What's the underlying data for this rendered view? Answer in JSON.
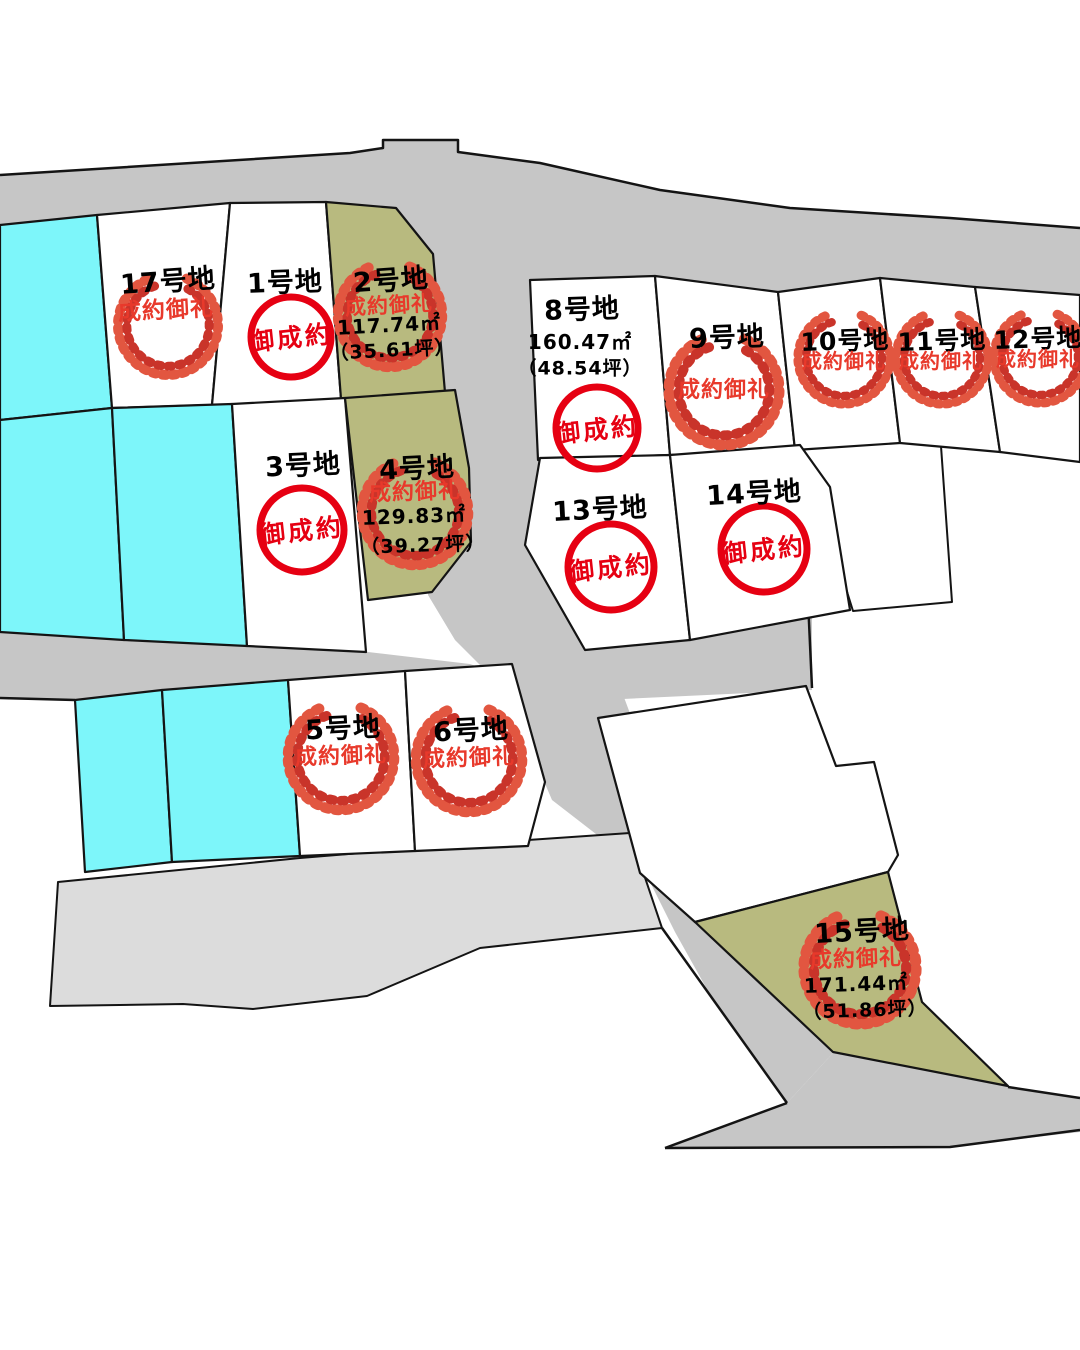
{
  "map": {
    "colors": {
      "road": "#C6C6C6",
      "road_light": "#DCDCDC",
      "parcel_white": "#FFFFFF",
      "parcel_cyan": "#7DF6FA",
      "parcel_olive": "#B8BA7F",
      "outline": "#141414",
      "stamp_circle_red": "#E60012",
      "wreath_outer": "#E25640",
      "wreath_inner": "#C9342A",
      "status_text_red": "#E8392B"
    }
  },
  "lots": {
    "lot1": {
      "name": "1号地",
      "stamp": "circle",
      "stamp_text": "御成約"
    },
    "lot2": {
      "name": "2号地",
      "stamp": "wreath",
      "stamp_text": "成約御礼",
      "area_m2": "117.74㎡",
      "area_tsubo": "（35.61坪）"
    },
    "lot3": {
      "name": "3号地",
      "stamp": "circle",
      "stamp_text": "御成約"
    },
    "lot4": {
      "name": "4号地",
      "stamp": "wreath",
      "stamp_text": "成約御礼",
      "area_m2": "129.83㎡",
      "area_tsubo": "（39.27坪）"
    },
    "lot5": {
      "name": "5号地",
      "stamp": "wreath",
      "stamp_text": "成約御礼"
    },
    "lot6": {
      "name": "6号地",
      "stamp": "wreath",
      "stamp_text": "成約御礼"
    },
    "lot8": {
      "name": "8号地",
      "stamp": "circle",
      "stamp_text": "御成約",
      "area_m2": "160.47㎡",
      "area_tsubo": "（48.54坪）"
    },
    "lot9": {
      "name": "9号地",
      "stamp": "wreath",
      "stamp_text": "成約御礼"
    },
    "lot10": {
      "name": "10号地",
      "stamp": "wreath",
      "stamp_text": "成約御礼"
    },
    "lot11": {
      "name": "11号地",
      "stamp": "wreath",
      "stamp_text": "成約御礼"
    },
    "lot12": {
      "name": "12号地",
      "stamp": "wreath",
      "stamp_text": "成約御礼"
    },
    "lot13": {
      "name": "13号地",
      "stamp": "circle",
      "stamp_text": "御成約"
    },
    "lot14": {
      "name": "14号地",
      "stamp": "circle",
      "stamp_text": "御成約"
    },
    "lot15": {
      "name": "15号地",
      "stamp": "wreath",
      "stamp_text": "成約御礼",
      "area_m2": "171.44㎡",
      "area_tsubo": "（51.86坪）"
    },
    "lot17": {
      "name": "17号地",
      "stamp": "wreath",
      "stamp_text": "成約御礼"
    }
  }
}
